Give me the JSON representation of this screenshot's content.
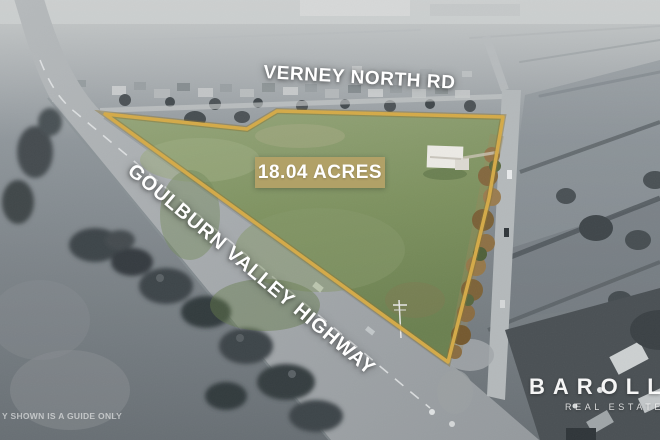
{
  "labels": {
    "top_road": "VERNEY NORTH RD",
    "area": "18.04 ACRES",
    "highway": "GOULBURN VALLEY HIGHWAY",
    "disclaimer": "Y SHOWN IS A GUIDE ONLY"
  },
  "brand": {
    "name": "BAROLLO",
    "tagline": "REAL ESTATE"
  },
  "colors": {
    "badge_gold": "#b1a167",
    "boundary_gold": "#d4aa48",
    "grass_green": "#7e9260",
    "overlay_text": "#ffffff"
  }
}
